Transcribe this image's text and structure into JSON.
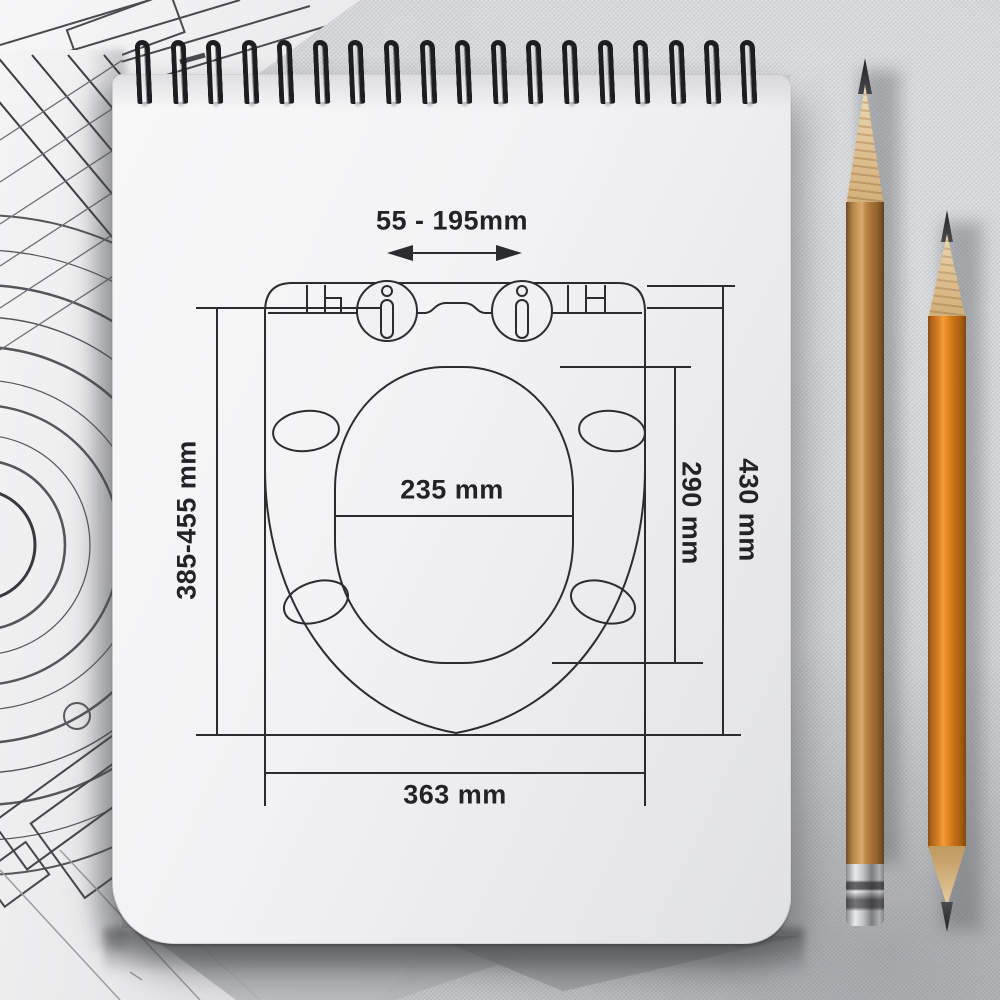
{
  "scene": {
    "description": "Technical dimension drawing of a toilet seat sketched on a white spiral notepad lying on a gray fabric desk, with blueprint sheets to the left and two sharpened pencils on the right"
  },
  "diagram": {
    "labels": {
      "hinge_distance": "55 - 195mm",
      "mounting_range": "385-455 mm",
      "inner_width": "235 mm",
      "inner_depth": "290 mm",
      "overall_depth": "430 mm",
      "overall_width": "363 mm"
    }
  },
  "notebook": {
    "spiral_loop_count": 18
  },
  "colors": {
    "ink": "#2b2c2e",
    "label_text": "#222326",
    "paper": "#f1f1f3",
    "fabric": "#d2d4d7",
    "spiral_metal": "#1d1e20",
    "wooden_pencil_body": "#b98a4e",
    "orange_pencil_body": "#d9822b",
    "ferrule_silver": "#c9cacd",
    "graphite": "#343539"
  }
}
